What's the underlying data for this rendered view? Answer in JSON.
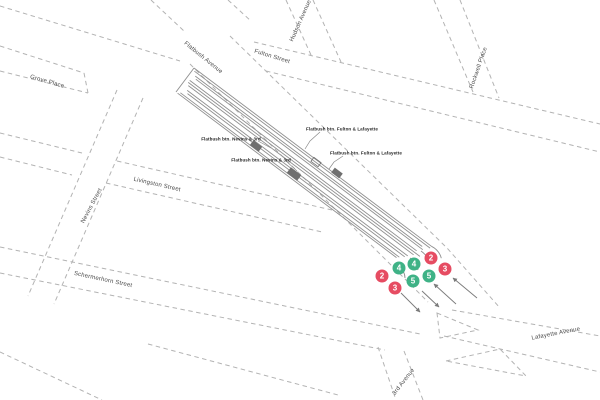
{
  "map": {
    "background_color": "#ffffff",
    "street_line_color": "#b3b3b3",
    "structure_line_color": "#8f8f8f",
    "stair_color": "#6f6f6f",
    "arrow_color": "#7a7a7a",
    "route_red": "#e64c62",
    "route_green": "#3fb286",
    "streets": [
      {
        "label": "Grove Place"
      },
      {
        "label": "Fulton Street"
      },
      {
        "label": "Flatbush Avenue"
      },
      {
        "label": "Hudson Avenue"
      },
      {
        "label": "Rockwell Place"
      },
      {
        "label": "Nevins Street"
      },
      {
        "label": "Livingston Street"
      },
      {
        "label": "Schermerhorn Street"
      },
      {
        "label": "Lafayette Avenue"
      },
      {
        "label": "3rd Avenue"
      }
    ],
    "annotations": [
      {
        "text": "Flatbush btn. Nevins & 3rd"
      },
      {
        "text": "Flatbush btn. Nevins & 3rd"
      },
      {
        "text": "Flatbush btn. Fulton & Lafayette"
      },
      {
        "text": "Flatbush btn. Fulton & Lafayette"
      }
    ],
    "route_bullets": [
      {
        "line": "2",
        "color": "#e64c62"
      },
      {
        "line": "3",
        "color": "#e64c62"
      },
      {
        "line": "4",
        "color": "#3fb286"
      },
      {
        "line": "5",
        "color": "#3fb286"
      },
      {
        "line": "4",
        "color": "#3fb286"
      },
      {
        "line": "5",
        "color": "#3fb286"
      },
      {
        "line": "2",
        "color": "#e64c62"
      },
      {
        "line": "3",
        "color": "#e64c62"
      }
    ]
  }
}
